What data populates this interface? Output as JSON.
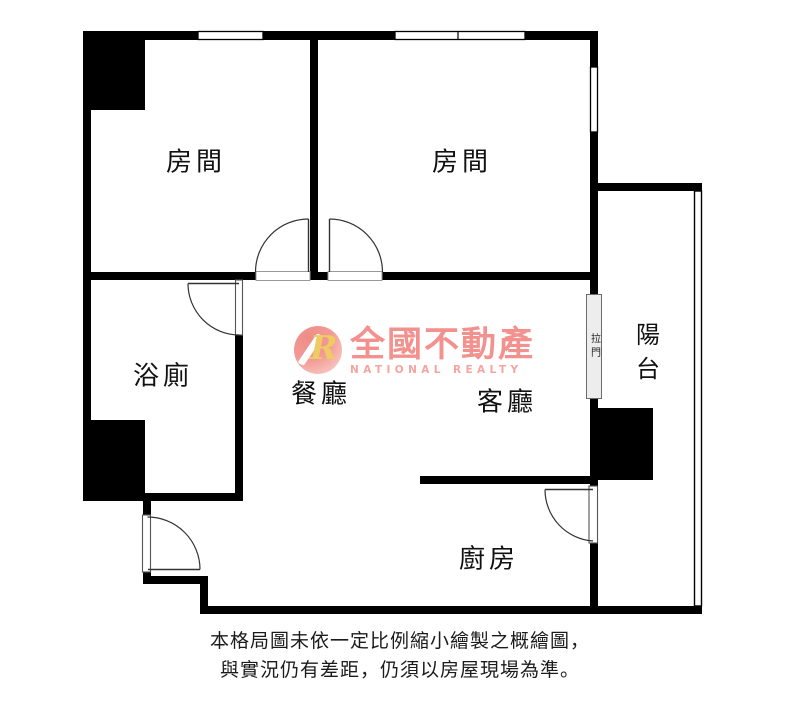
{
  "plan": {
    "labels": {
      "bedroom_left": "房間",
      "bedroom_right": "房間",
      "bathroom": "浴廁",
      "dining": "餐廳",
      "living": "客廳",
      "kitchen": "廚房",
      "balcony": "陽台",
      "sliding_door": "拉門"
    },
    "watermark": {
      "monogram": "R",
      "brand_zh": "全國不動產",
      "brand_en": "NATIONAL REALTY"
    },
    "disclaimer": {
      "line1": "本格局圖未依一定比例縮小繪製之概繪圖，",
      "line2": "與實況仍有差距，仍須以房屋現場為準。"
    },
    "colors": {
      "wall": "#000000",
      "brand_pink": "#f2918d",
      "brand_gold": "#eecb63",
      "sliding_door_fill": "#ededed",
      "text": "#1b1b1b"
    }
  }
}
